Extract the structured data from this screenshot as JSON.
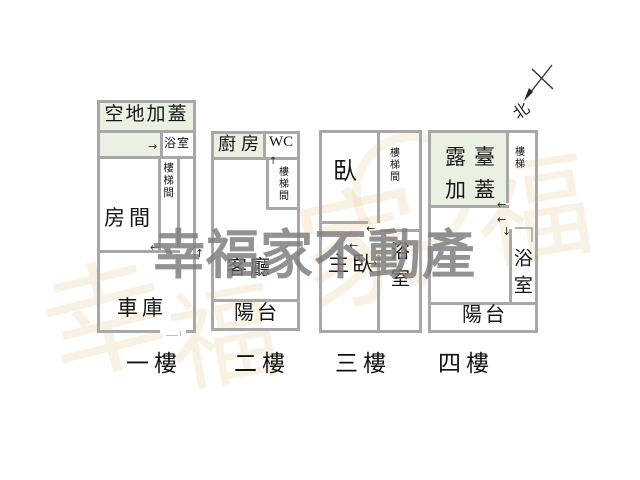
{
  "brand": {
    "watermark_text": "幸福家不動產"
  },
  "compass": {
    "north_label": "北"
  },
  "floors": {
    "f1": {
      "label": "一樓",
      "open_addition": "空地加蓋",
      "bathroom": "浴室",
      "stairwell": "樓梯間",
      "room": "房間",
      "garage": "車庫"
    },
    "f2": {
      "label": "二樓",
      "kitchen": "廚房",
      "wc": "WC",
      "stairwell": "樓梯間",
      "living_room": "客廳",
      "balcony": "陽台"
    },
    "f3": {
      "label": "三樓",
      "bedroom": "臥",
      "stairwell": "樓梯間",
      "master_bedroom": "主臥",
      "bathroom": "浴室"
    },
    "f4": {
      "label": "四樓",
      "terrace_addition": "露臺加蓋",
      "stairs": "樓梯",
      "bathroom": "浴室",
      "balcony": "陽台"
    }
  },
  "arrows": {
    "left": "←",
    "right": "→",
    "up": "↑",
    "down": "↓"
  },
  "ghost_watermark": {
    "c1": "幸",
    "c2": "福",
    "c3": "家",
    "c4": "福"
  },
  "colors": {
    "wall": "#a8a8a8",
    "room_tint": "#eaf0e2",
    "brand_gray": "#7d7d7d",
    "ghost_orange": "#dfae5e"
  }
}
